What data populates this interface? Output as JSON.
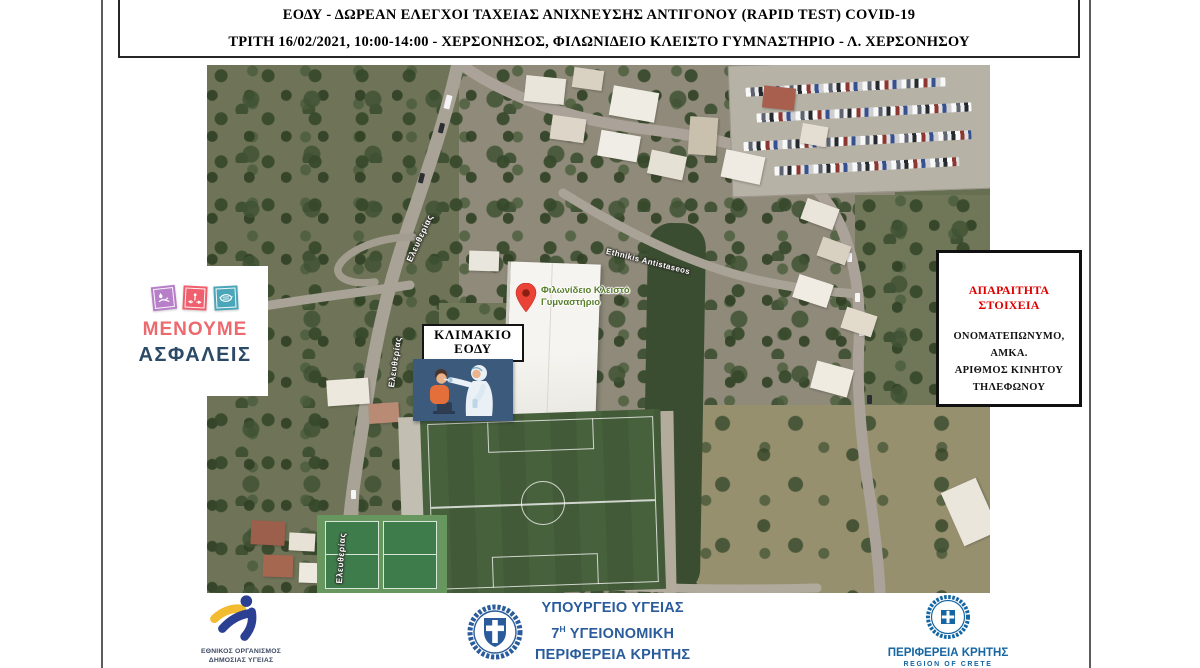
{
  "header": {
    "line1": "ΕΟΔΥ - ΔΩΡΕΑΝ ΕΛΕΓΧΟΙ ΤΑΧΕΙΑΣ ΑΝΙΧΝΕΥΣΗΣ ΑΝΤΙΓΟΝΟΥ (RAPID TEST) COVID-19",
    "line2": "ΤΡΙΤΗ 16/02/2021, 10:00-14:00 - ΧΕΡΣΟΝΗΣΟΣ, ΦΙΛΩΝΙΔΕΙΟ ΚΛΕΙΣΤΟ ΓΥΜΝΑΣΤΗΡΙΟ - Λ. ΧΕΡΣΟΝΗΣΟΥ"
  },
  "map": {
    "streets": {
      "eleftherias": "Ελευθερίας",
      "ethnikis": "Ethnikis Antistaseos"
    },
    "pin": {
      "label_line1": "Φιλωνίδειο Κλειστό",
      "label_line2": "Γυμναστήριο",
      "color": "#ea4335",
      "label_color": "#587e2c"
    },
    "klimakio": {
      "line1": "ΚΛΙΜΑΚΙΟ",
      "line2": "ΕΟΔΥ"
    }
  },
  "menoume": {
    "line1": "ΜΕΝΟΥΜΕ",
    "line2": "ΑΣΦΑΛΕΙΣ",
    "colors": {
      "line1": "#ec6a6e",
      "line2": "#2b4a68",
      "square_handwash": "#b67fc8",
      "square_distance": "#ef5f6d",
      "square_mask": "#4aa6b8"
    }
  },
  "required_info": {
    "title": "ΑΠΑΡΑΙΤΗΤΑ ΣΤΟΙΧΕΙΑ",
    "title_color": "#e00000",
    "lines": [
      "ΟΝΟΜΑΤΕΠΩΝΥΜΟ,",
      "ΑΜΚΑ.",
      "ΑΡΙΘΜΟΣ ΚΙΝΗΤΟΥ",
      "ΤΗΛΕΦΩΝΟΥ"
    ]
  },
  "footer": {
    "eody": {
      "line1": "ΕΘΝΙΚΟΣ ΟΡΓΑΝΙΣΜΟΣ",
      "line2": "ΔΗΜΟΣΙΑΣ ΥΓΕΙΑΣ"
    },
    "ministry": {
      "line1": "ΥΠΟΥΡΓΕΙΟ ΥΓΕΙΑΣ",
      "line2_num": "7",
      "line2_sup": "Η",
      "line2_rest": "ΥΓΕΙΟΝΟΜΙΚΗ",
      "line3": "ΠΕΡΙΦΕΡΕΙΑ ΚΡΗΤΗΣ",
      "color": "#2a5c9c"
    },
    "crete": {
      "line1": "ΠΕΡΙΦΕΡΕΙΑ ΚΡΗΤΗΣ",
      "line2": "REGION OF CRETE",
      "color": "#1566a3"
    }
  }
}
